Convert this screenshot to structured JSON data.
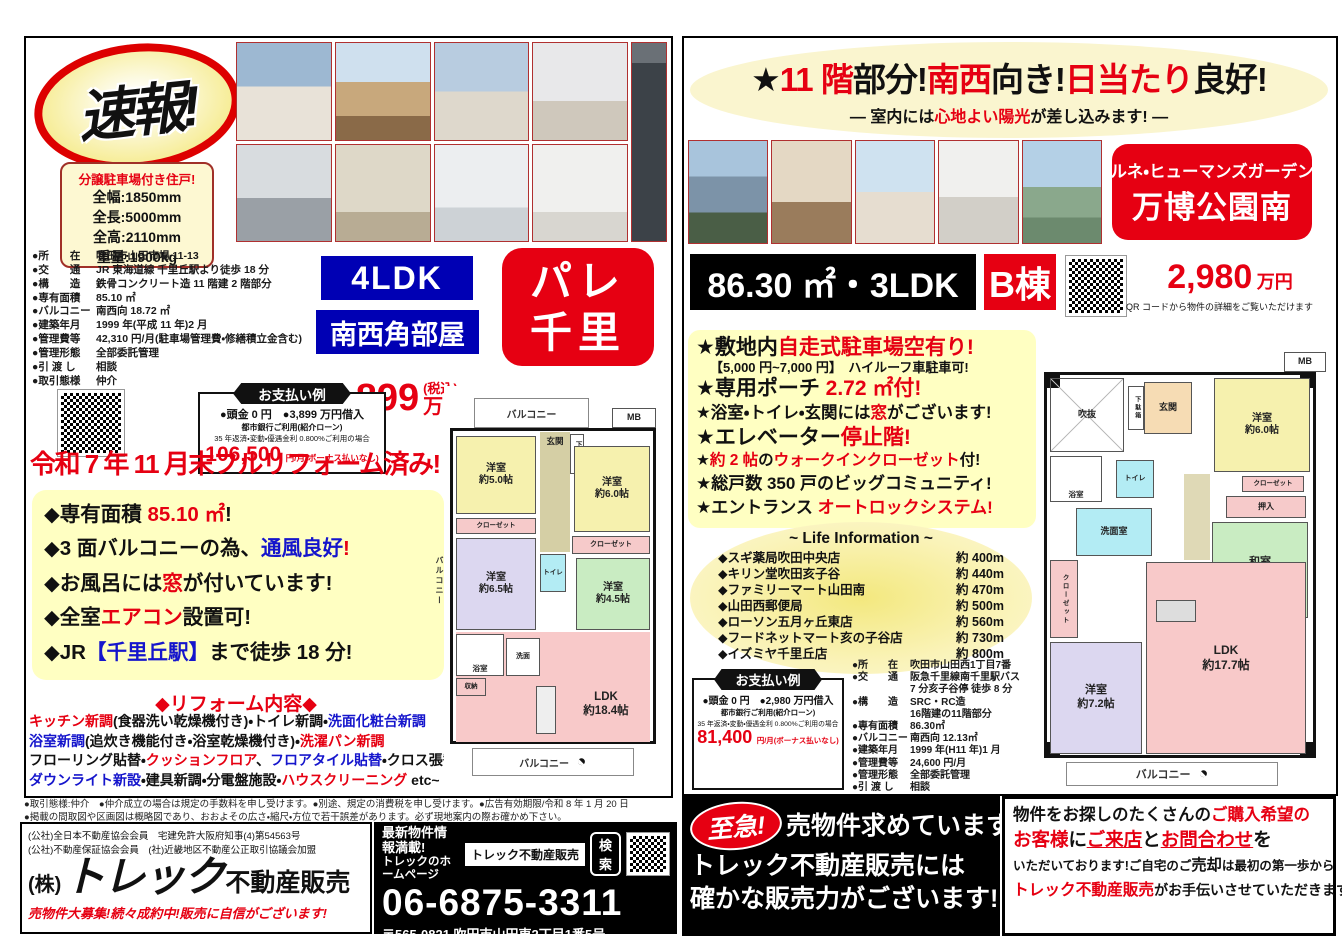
{
  "left": {
    "flash": "速報!",
    "parking": {
      "title": "分譲駐車場付き住戸!",
      "specs": [
        "全幅:1850mm",
        "全長:5000mm",
        "全高:2110mm",
        "重量:1900kg"
      ]
    },
    "details": [
      {
        "label": "●所　　在",
        "value": "吹田市山田市場 11-13"
      },
      {
        "label": "●交　　通",
        "value": "JR 東海道線 千里丘駅より徒歩 18 分"
      },
      {
        "label": "●構　　造",
        "value": "鉄骨コンクリート造 11 階建 2 階部分"
      },
      {
        "label": "●専有面積",
        "value": "85.10 ㎡"
      },
      {
        "label": "●バルコニー",
        "value": "南西向 18.72 ㎡"
      },
      {
        "label": "●建築年月",
        "value": "1999 年(平成 11 年)2 月"
      },
      {
        "label": "●管理費等",
        "value": "42,310 円/月(駐車場管理費・修繕積立金含む)"
      },
      {
        "label": "●管理形態",
        "value": "全部委託管理"
      },
      {
        "label": "●引 渡 し",
        "value": "相談"
      },
      {
        "label": "●取引態様",
        "value": "仲介"
      }
    ],
    "layout_badge": "4LDK",
    "corner_badge": "南西角部屋",
    "name_line1": "パレ",
    "name_line2": "千里",
    "price": {
      "amount": "3,899",
      "tax_note": "(税込)",
      "unit": "万円"
    },
    "payment": {
      "title": "お支払い例",
      "line1": "●頭金 0 円　●3,899 万円借入",
      "line2": "都市銀行ご利用(紹介ローン)",
      "line3": "35 年返済・変動・優遇金利 0.800%ご利用の場合",
      "amount": "106,500",
      "suffix": "円/月(ボーナス払いなし)"
    },
    "headline": "令和 7 年 11 月末フルリフォーム済み!",
    "features": [
      [
        {
          "t": "◆専有面積 ",
          "c": "k"
        },
        {
          "t": "85.10 ㎡",
          "c": "r"
        },
        {
          "t": "!",
          "c": "k"
        }
      ],
      [
        {
          "t": "◆3 面バルコニーの為、",
          "c": "k"
        },
        {
          "t": "通風良好",
          "c": "b"
        },
        {
          "t": "!",
          "c": "r"
        }
      ],
      [
        {
          "t": "◆お風呂には",
          "c": "k"
        },
        {
          "t": "窓",
          "c": "r"
        },
        {
          "t": "が付いています!",
          "c": "k"
        }
      ],
      [
        {
          "t": "◆全室",
          "c": "k"
        },
        {
          "t": "エアコン",
          "c": "r"
        },
        {
          "t": "設置可!",
          "c": "k"
        }
      ],
      [
        {
          "t": "◆JR",
          "c": "k"
        },
        {
          "t": "【千里丘駅】",
          "c": "b"
        },
        {
          "t": "まで徒歩 18 分!",
          "c": "k"
        }
      ]
    ],
    "reform_title": "◆リフォーム内容◆",
    "reform": [
      [
        {
          "t": "キッチン新調",
          "c": "r"
        },
        {
          "t": "(食器洗い乾燥機付き)・トイレ新調・",
          "c": "k"
        },
        {
          "t": "洗面化粧台新調",
          "c": "b"
        }
      ],
      [
        {
          "t": "浴室新調",
          "c": "b"
        },
        {
          "t": "(追炊き機能付き・浴室乾燥機付き)・",
          "c": "k"
        },
        {
          "t": "洗濯パン新調",
          "c": "r"
        }
      ],
      [
        {
          "t": "フローリング貼替・",
          "c": "k"
        },
        {
          "t": "クッションフロア",
          "c": "r"
        },
        {
          "t": "、",
          "c": "k"
        },
        {
          "t": "フロアタイル貼替",
          "c": "b"
        },
        {
          "t": "・クロス張替",
          "c": "k"
        }
      ],
      [
        {
          "t": "ダウンライト新設",
          "c": "b"
        },
        {
          "t": "・建具新調・分電盤施設・",
          "c": "k"
        },
        {
          "t": "ハウスクリーニング",
          "c": "r"
        },
        {
          "t": " etc~",
          "c": "k"
        }
      ]
    ],
    "plan": {
      "balcony_top": "バルコニー",
      "balcony_left": "バルコニー",
      "balcony_bottom": "バルコニー",
      "mb": "MB",
      "genkan": "玄関",
      "getabako": "下駄箱",
      "r50": "洋室\n約5.0帖",
      "r60": "洋室\n約6.0帖",
      "r65": "洋室\n約6.5帖",
      "r45": "洋室\n約4.5帖",
      "closet1": "クローゼット",
      "closet2": "クローゼット",
      "toilet": "トイレ",
      "bath": "浴室",
      "wash": "洗面",
      "storage": "収納",
      "ldk": "LDK\n約18.4帖"
    }
  },
  "right": {
    "header_parts": [
      {
        "t": "★",
        "c": "k"
      },
      {
        "t": "11 階",
        "c": "r"
      },
      {
        "t": "部分!",
        "c": "k"
      },
      {
        "t": "南西",
        "c": "r"
      },
      {
        "t": "向き!",
        "c": "k"
      },
      {
        "t": "日当たり",
        "c": "r"
      },
      {
        "t": "良好!",
        "c": "k"
      }
    ],
    "sub_parts": [
      {
        "t": "― 室内には",
        "c": "k"
      },
      {
        "t": "心地よい陽光",
        "c": "r"
      },
      {
        "t": "が差し込みます! ―",
        "c": "k"
      }
    ],
    "name_box": {
      "line1": "ルネ・ヒューマンズガーデン",
      "line2": "万博公園南"
    },
    "spec_bar": "86.30 ㎡・3LDK",
    "building": "B棟",
    "price": "2,980",
    "price_unit": "万円",
    "qr_caption": "QR コードから物件の詳細をご覧いただけます",
    "bullets": [
      [
        {
          "t": "★敷地内",
          "c": "k"
        },
        {
          "t": "自走式駐車場空有り!",
          "c": "r"
        }
      ],
      [
        {
          "t": "★専用ポーチ ",
          "c": "k"
        },
        {
          "t": "2.72 ㎡付!",
          "c": "r"
        }
      ],
      [
        {
          "t": "★浴室・トイレ・玄関には",
          "c": "k"
        },
        {
          "t": "窓",
          "c": "r"
        },
        {
          "t": "がございます!",
          "c": "k"
        }
      ],
      [
        {
          "t": "★エレベーター",
          "c": "k"
        },
        {
          "t": "停止階!",
          "c": "r"
        }
      ],
      [
        {
          "t": "★",
          "c": "k"
        },
        {
          "t": "約 2 帖",
          "c": "r"
        },
        {
          "t": "の",
          "c": "k"
        },
        {
          "t": "ウォークインクローゼット",
          "c": "r"
        },
        {
          "t": "付!",
          "c": "k"
        }
      ],
      [
        {
          "t": "★総戸数 350 戸のビッグコミュニティ!",
          "c": "k"
        }
      ],
      [
        {
          "t": "★エントランス ",
          "c": "k"
        },
        {
          "t": "オートロックシステム!",
          "c": "r"
        }
      ]
    ],
    "bullet_sub": "【5,000 円~7,000 円】　ハイルーフ車駐車可!",
    "life": {
      "title": "~ Life Information ~",
      "items": [
        {
          "name": "◆スギ薬局吹田中央店",
          "dist": "約 400m"
        },
        {
          "name": "◆キリン堂吹田亥子谷",
          "dist": "約 440m"
        },
        {
          "name": "◆ファミリーマート山田南",
          "dist": "約 470m"
        },
        {
          "name": "◆山田西郵便局",
          "dist": "約 500m"
        },
        {
          "name": "◆ローソン五月ヶ丘東店",
          "dist": "約 560m"
        },
        {
          "name": "◆フードネットマート亥の子谷店",
          "dist": "約 730m"
        },
        {
          "name": "◆イズミヤ千里丘店",
          "dist": "約 800m"
        }
      ]
    },
    "payment": {
      "title": "お支払い例",
      "line1": "●頭金 0 円　●2,980 万円借入",
      "line2": "都市銀行ご利用(紹介ローン)",
      "line3": "35 年返済・変動・優遇金利 0.800%ご利用の場合",
      "amount": "81,400",
      "suffix": "円/月(ボーナス払いなし)"
    },
    "details": [
      {
        "label": "●所　　在",
        "value": "吹田市山田西1丁目7番"
      },
      {
        "label": "●交　　通",
        "value": "阪急千里線南千里駅バス\n7 分亥子谷停 徒歩 8 分"
      },
      {
        "label": "●構　　造",
        "value": "SRC・RC造\n16階建の11階部分"
      },
      {
        "label": "●専有面積",
        "value": "86.30㎡"
      },
      {
        "label": "●バルコニー",
        "value": "南西向 12.13㎡"
      },
      {
        "label": "●建築年月",
        "value": "1999 年(H11 年)1 月"
      },
      {
        "label": "●管理費等",
        "value": "24,600 円/月"
      },
      {
        "label": "●管理形態",
        "value": "全部委託管理"
      },
      {
        "label": "●引 渡 し",
        "value": "相談"
      }
    ],
    "plan": {
      "mb": "MB",
      "fukinuke": "吹抜",
      "genkan": "玄関",
      "getabako": "下駄箱",
      "r60": "洋室\n約6.0帖",
      "bath": "浴室",
      "toilet": "トイレ",
      "wash": "洗面室",
      "closet": "クローゼット",
      "oshiire": "押入",
      "washitsu": "和室\n6帖",
      "wic": "クローゼット",
      "r72": "洋室\n約7.2帖",
      "ldk": "LDK\n約17.7帖",
      "balcony_bottom": "バルコニー"
    }
  },
  "footer": {
    "fine1": "●取引態様:仲介　●仲介成立の場合は規定の手数料を申し受けます。●別途、規定の消費税を申し受けます。●広告有効期限/令和 8 年 1 月 20 日",
    "fine2": "●掲載の間取図や区画図は概略図であり、おおよその広さ・縮尺・方位で若干誤差があります。必ず現地案内の際お確かめ下さい。",
    "cred1": "(公社)全日本不動産協会会員　宅建免許大阪府知事(4)第54563号",
    "cred2": "(公社)不動産保証協会会員　(社)近畿地区不動産公正取引協議会加盟",
    "company_prefix": "(株)",
    "company_name": "トレック",
    "company_suffix": "不動産販売",
    "slogan": "売物件大募集!続々成約中!販売に自信がございます!",
    "web1": "最新物件情報満載!",
    "web2": "トレックのホームページ",
    "search_label": "トレック不動産販売",
    "search_btn": "検索",
    "tel": "06-6875-3311",
    "addr": "〒565-0821 吹田市山田東2丁目1番5号",
    "urgent_badge": "至急!",
    "urgent_l1": "売物件求めています!",
    "urgent_l2": "トレック不動産販売には",
    "urgent_l3": "確かな販売力がございます!",
    "promo": [
      [
        {
          "t": "物件をお探しのたくさんの",
          "c": "k"
        },
        {
          "t": "ご購入希望の",
          "c": "r"
        }
      ],
      [
        {
          "t": "お客様",
          "c": "r"
        },
        {
          "t": "に",
          "c": "k"
        },
        {
          "t": "ご来店",
          "c": "ru"
        },
        {
          "t": "と",
          "c": "k"
        },
        {
          "t": "お問合わせ",
          "c": "ru"
        },
        {
          "t": "を",
          "c": "k"
        }
      ],
      [
        {
          "t": "いただいております!ご自宅のご",
          "c": "k"
        },
        {
          "t": "売却",
          "c": "kb"
        },
        {
          "t": "は最初の第一歩から",
          "c": "k"
        }
      ],
      [
        {
          "t": "トレック不動産販売",
          "c": "rb"
        },
        {
          "t": "がお手伝いさせていただきます!",
          "c": "k"
        }
      ]
    ]
  }
}
